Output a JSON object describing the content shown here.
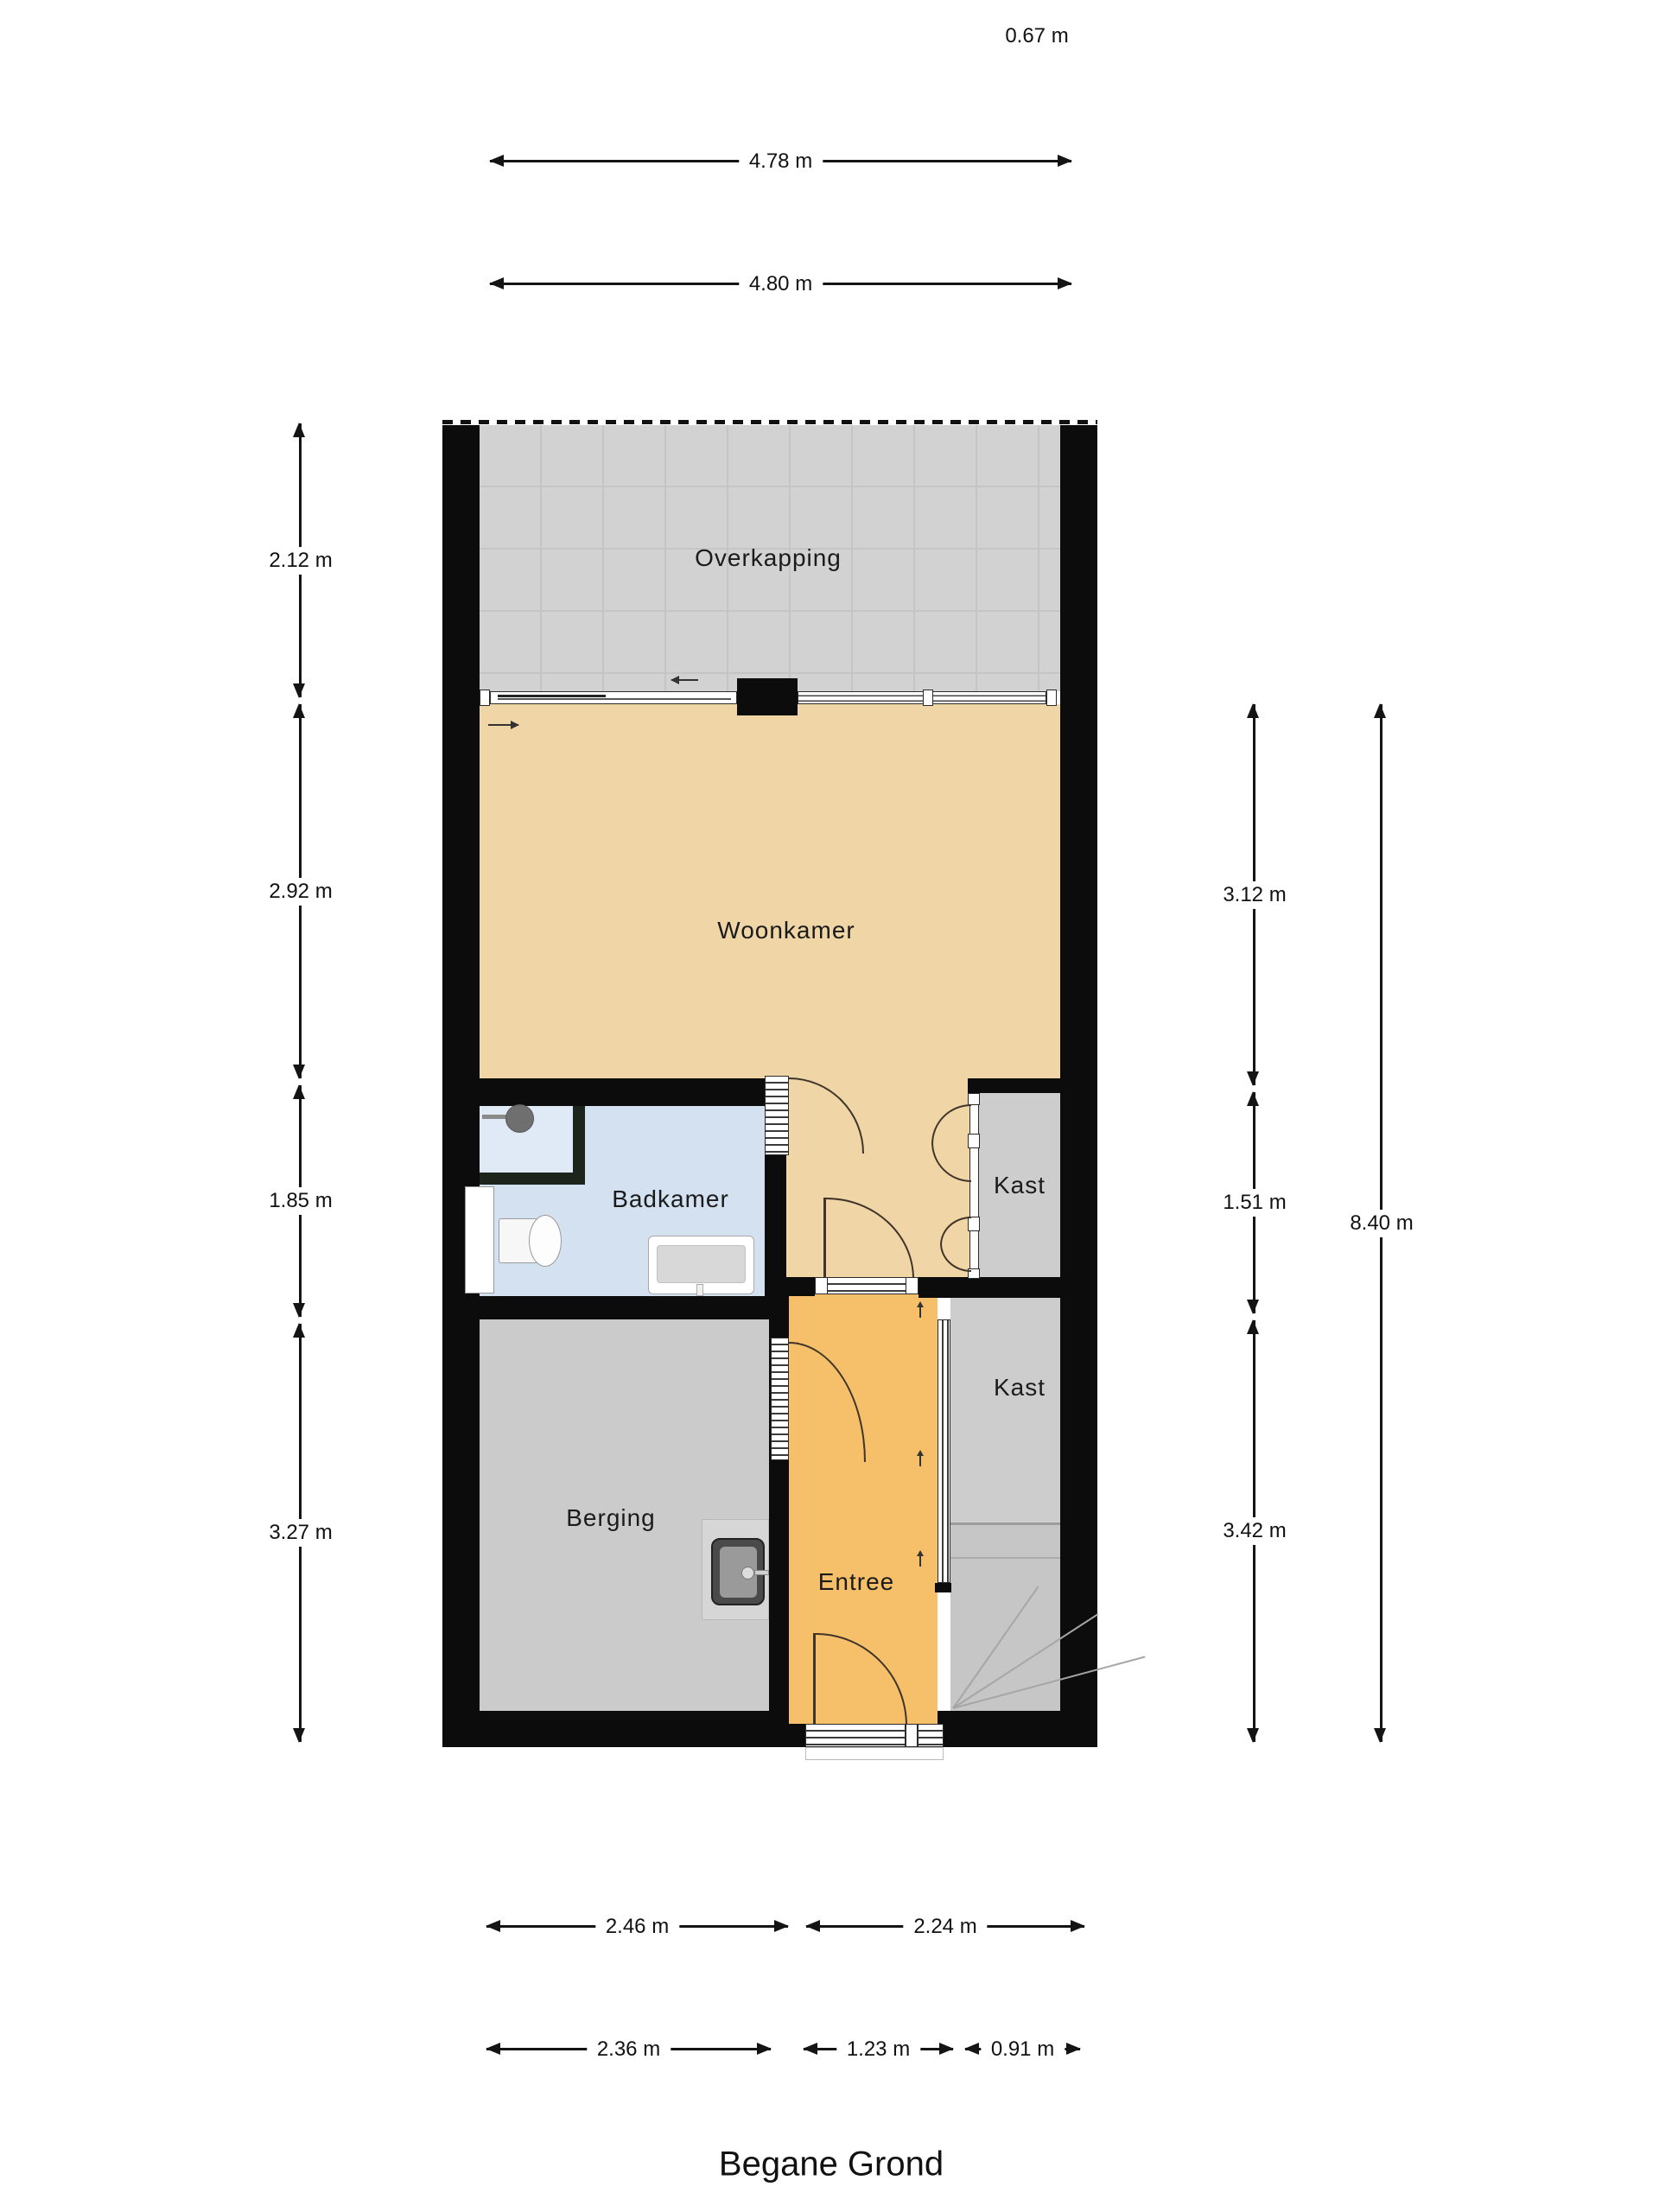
{
  "title": "Begane Grond",
  "rooms": {
    "overkapping": "Overkapping",
    "woonkamer": "Woonkamer",
    "badkamer": "Badkamer",
    "kast_boven": "Kast",
    "kast_onder": "Kast",
    "berging": "Berging",
    "entree": "Entree"
  },
  "dimensions": {
    "top_offset": "0.67 m",
    "top": [
      {
        "label": "4.78 m"
      },
      {
        "label": "4.80 m"
      }
    ],
    "left": [
      {
        "label": "2.12 m"
      },
      {
        "label": "2.92 m"
      },
      {
        "label": "1.85 m"
      },
      {
        "label": "3.27 m"
      }
    ],
    "right": [
      {
        "label": "3.12 m"
      },
      {
        "label": "1.51 m"
      },
      {
        "label": "3.42 m"
      }
    ],
    "right_total": "8.40 m",
    "bottom_row1": [
      {
        "label": "2.46 m"
      },
      {
        "label": "2.24 m"
      }
    ],
    "bottom_row2": [
      {
        "label": "2.36 m"
      },
      {
        "label": "1.23 m"
      },
      {
        "label": "0.91 m"
      }
    ]
  },
  "colors": {
    "wall": "#0c0c0c",
    "living": "#f0d6a7",
    "entree": "#f6c06b",
    "bathroom": "#d3e1f0",
    "shower": "#dfeaf6",
    "storage_gray": "#cbcbcb",
    "closet_gray": "#cdcdcd",
    "canopy_gray": "#d2d2d2",
    "stairs_gray": "#c6c6c6",
    "door_arc": "#40352a"
  }
}
